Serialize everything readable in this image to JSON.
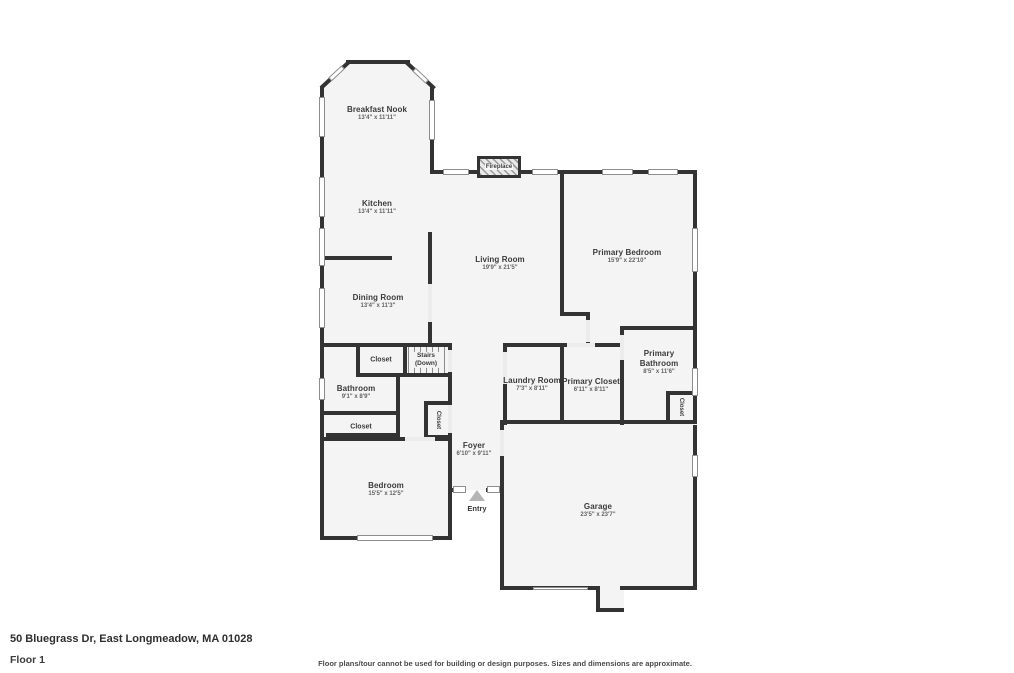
{
  "footer": {
    "address": "50 Bluegrass Dr, East Longmeadow, MA 01028",
    "floor": "Floor 1",
    "disclaimer": "Floor plans/tour cannot be used for building or design purposes. Sizes and dimensions are approximate."
  },
  "colors": {
    "wall": "#333333",
    "room_fill": "#f4f4f4",
    "window": "#ffffff",
    "text": "#3a3a3a"
  },
  "rooms": {
    "breakfast_nook": {
      "name": "Breakfast Nook",
      "dims": "13'4\" x 11'11\""
    },
    "kitchen": {
      "name": "Kitchen",
      "dims": "13'4\" x 11'11\""
    },
    "dining_room": {
      "name": "Dining Room",
      "dims": "13'4\" x 11'3\""
    },
    "living_room": {
      "name": "Living Room",
      "dims": "19'9\" x 21'5\""
    },
    "primary_bedroom": {
      "name": "Primary Bedroom",
      "dims": "15'9\" x 22'10\""
    },
    "bathroom": {
      "name": "Bathroom",
      "dims": "9'1\" x 8'9\""
    },
    "laundry_room": {
      "name": "Laundry Room",
      "dims": "7'3\" x 8'11\""
    },
    "primary_closet": {
      "name": "Primary Closet",
      "dims": "6'11\" x 8'11\""
    },
    "primary_bathroom": {
      "name": "Primary Bathroom",
      "dims": "8'5\" x 11'6\""
    },
    "foyer": {
      "name": "Foyer",
      "dims": "6'10\" x 9'11\""
    },
    "bedroom": {
      "name": "Bedroom",
      "dims": "15'5\" x 12'5\""
    },
    "garage": {
      "name": "Garage",
      "dims": "23'5\" x 23'7\""
    }
  },
  "features": {
    "fireplace": "Fireplace",
    "stairs_line1": "Stairs",
    "stairs_line2": "(Down)",
    "entry": "Entry",
    "closet": "Closet"
  }
}
